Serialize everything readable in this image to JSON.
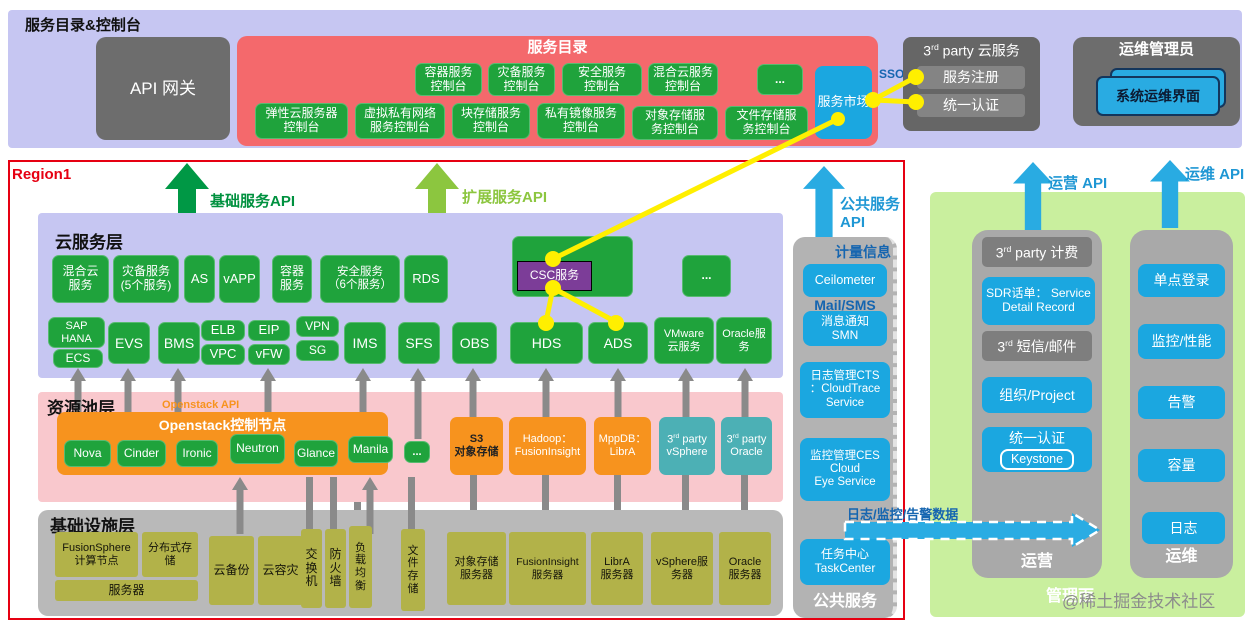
{
  "top": {
    "title": "服务目录&控制台",
    "api_gateway": "API 网关",
    "catalog": {
      "title": "服务目录",
      "row1": [
        "容器服务\n控制台",
        "灾备服务\n控制台",
        "安全服务\n控制台",
        "混合云服务\n控制台"
      ],
      "ellipsis": "...",
      "market": "服务市场",
      "row2": [
        "弹性云服务器\n控制台",
        "虚拟私有网络\n服务控制台",
        "块存储服务\n控制台",
        "私有镜像服务\n控制台",
        "对象存储服\n务控制台",
        "文件存储服\n务控制台"
      ]
    },
    "sso": "SSO",
    "third_party": {
      "pre": "3",
      "sup": "rd",
      "post": " party 云服务",
      "items": [
        "服务注册",
        "统一认证"
      ]
    },
    "ops_admin": {
      "title": "运维管理员",
      "console": "系统运维界面"
    }
  },
  "region": {
    "label": "Region1",
    "api_basic": "基础服务API",
    "api_extended": "扩展服务API",
    "api_public": "公共服务\nAPI",
    "cloud": {
      "title": "云服务层",
      "row1": [
        "混合云\n服务",
        "灾备服务\n(5个服务)",
        "AS",
        "vAPP",
        "容器\n服务",
        "安全服务\n（6个服务）",
        "RDS"
      ],
      "csc": "CSC服务",
      "ellipsis": "...",
      "row2": [
        "SAP\nHANA",
        "ECS",
        "EVS",
        "BMS",
        "ELB",
        "VPC",
        "EIP",
        "vFW",
        "VPN",
        "SG",
        "IMS",
        "SFS",
        "OBS",
        "HDS",
        "ADS",
        "VMware\n云服务",
        "Oracle服\n务"
      ]
    },
    "resource": {
      "title": "资源池层",
      "openstack_api": "Openstack API",
      "openstack": "Openstack控制节点",
      "components": [
        "Nova",
        "Cinder",
        "Ironic",
        "Neutron",
        "Glance",
        "Manila",
        "..."
      ],
      "s3": "S3\n对象存储",
      "hadoop": "Hadoop：\nFusionInsight",
      "mppdb": "MppDB：\nLibrA",
      "vsphere": {
        "pre": "3",
        "sup": "rd",
        "post": " party\nvSphere"
      },
      "oracle": {
        "pre": "3",
        "sup": "rd",
        "post": " party\nOracle"
      }
    },
    "infra": {
      "title": "基础设施层",
      "fusionsphere": "FusionSphere\n计算节点",
      "dist_storage": "分布式存\n储",
      "server": "服务器",
      "cloud_backup": "云备份",
      "cloud_dr": "云容灾",
      "switch": "交\n换\n机",
      "firewall": "防\n火\n墙",
      "lb": "负\n载\n均\n衡",
      "file_storage": "文\n件\n存\n储",
      "obj_server": "对象存储\n服务器",
      "fi_server": "FusionInsight\n服务器",
      "libra_server": "LibrA\n服务器",
      "vsphere_server": "vSphere服\n务器",
      "oracle_server": "Oracle\n服务器"
    }
  },
  "public_svc": {
    "metering": "计量信息",
    "ceilometer": "Ceilometer",
    "mail_label": "Mail/SMS",
    "smn": "消息通知\nSMN",
    "cts": "日志管理CTS\n：CloudTrace\nService",
    "ces": "监控管理CES\nCloud\nEye Service",
    "task": "任务中心\nTaskCenter",
    "label": "公共服务",
    "data_arrow": "日志/监控/告警数据"
  },
  "mgmt": {
    "ops_api": "运营 API",
    "om_api": "运维 API",
    "operation": {
      "billing": {
        "pre": "3",
        "sup": "rd",
        "post": " party 计费"
      },
      "sdr": "SDR话单： Service\nDetail Record",
      "sms": {
        "pre": "3",
        "sup": "rd",
        "post": " 短信/邮件"
      },
      "org": "组织/Project",
      "auth": "统一认证",
      "keystone": "Keystone",
      "label": "运营"
    },
    "om": {
      "items": [
        "单点登录",
        "监控/性能",
        "告警",
        "容量",
        "日志"
      ],
      "label": "运维"
    },
    "plane": "管理面"
  },
  "colors": {
    "accent_green": "#1fa33c",
    "accent_blue": "#29abe2",
    "accent_orange": "#f7931e",
    "accent_red_panel": "#f4696c",
    "region_border": "#e60012",
    "yellow_link": "#ffef00"
  },
  "watermark": "@稀土掘金技术社区"
}
